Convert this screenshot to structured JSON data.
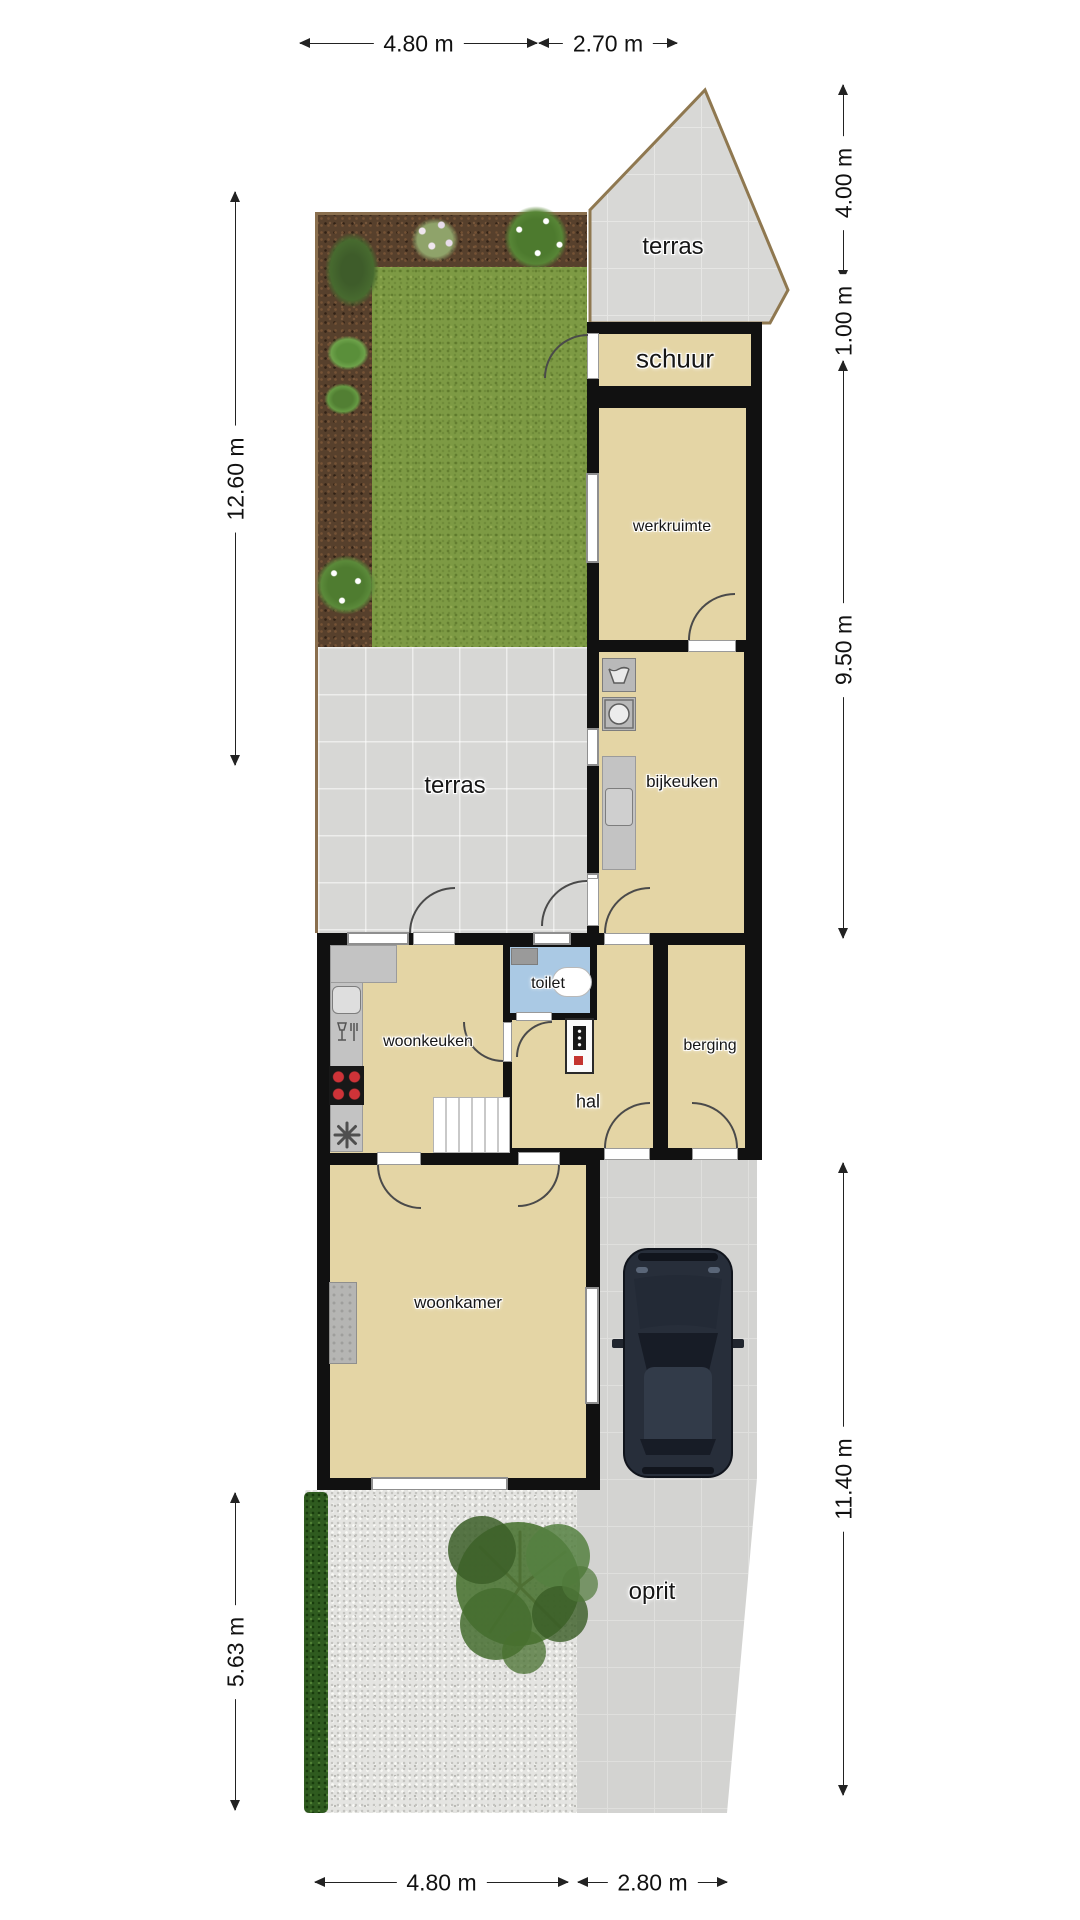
{
  "plan": {
    "rooms": {
      "terras_top": "terras",
      "schuur": "schuur",
      "werkruimte": "werkruimte",
      "bijkeuken": "bijkeuken",
      "terras_mid": "terras",
      "woonkeuken": "woonkeuken",
      "toilet": "toilet",
      "hal": "hal",
      "berging": "berging",
      "woonkamer": "woonkamer",
      "oprit": "oprit"
    },
    "dimensions": {
      "top": [
        {
          "label": "4.80 m"
        },
        {
          "label": "2.70 m"
        }
      ],
      "right": [
        {
          "label": "4.00 m"
        },
        {
          "label": "1.00 m"
        },
        {
          "label": "9.50 m"
        },
        {
          "label": "11.40 m"
        }
      ],
      "bottom": [
        {
          "label": "4.80 m"
        },
        {
          "label": "2.80 m"
        }
      ],
      "left": [
        {
          "label": "12.60 m"
        },
        {
          "label": "5.63 m"
        }
      ]
    },
    "colors": {
      "room_fill": "#e4d5a5",
      "wall": "#111111",
      "terrace": "#d7d7d5",
      "grass": "#7d9a44",
      "soil": "#57402c",
      "toilet_blue": "#aac9e4",
      "driveway": "#d3d3d1",
      "gravel": "#e4e4e1",
      "hedge": "#2f5b1f",
      "car_body": "#272e3a",
      "fence": "#8a6f4e"
    }
  }
}
